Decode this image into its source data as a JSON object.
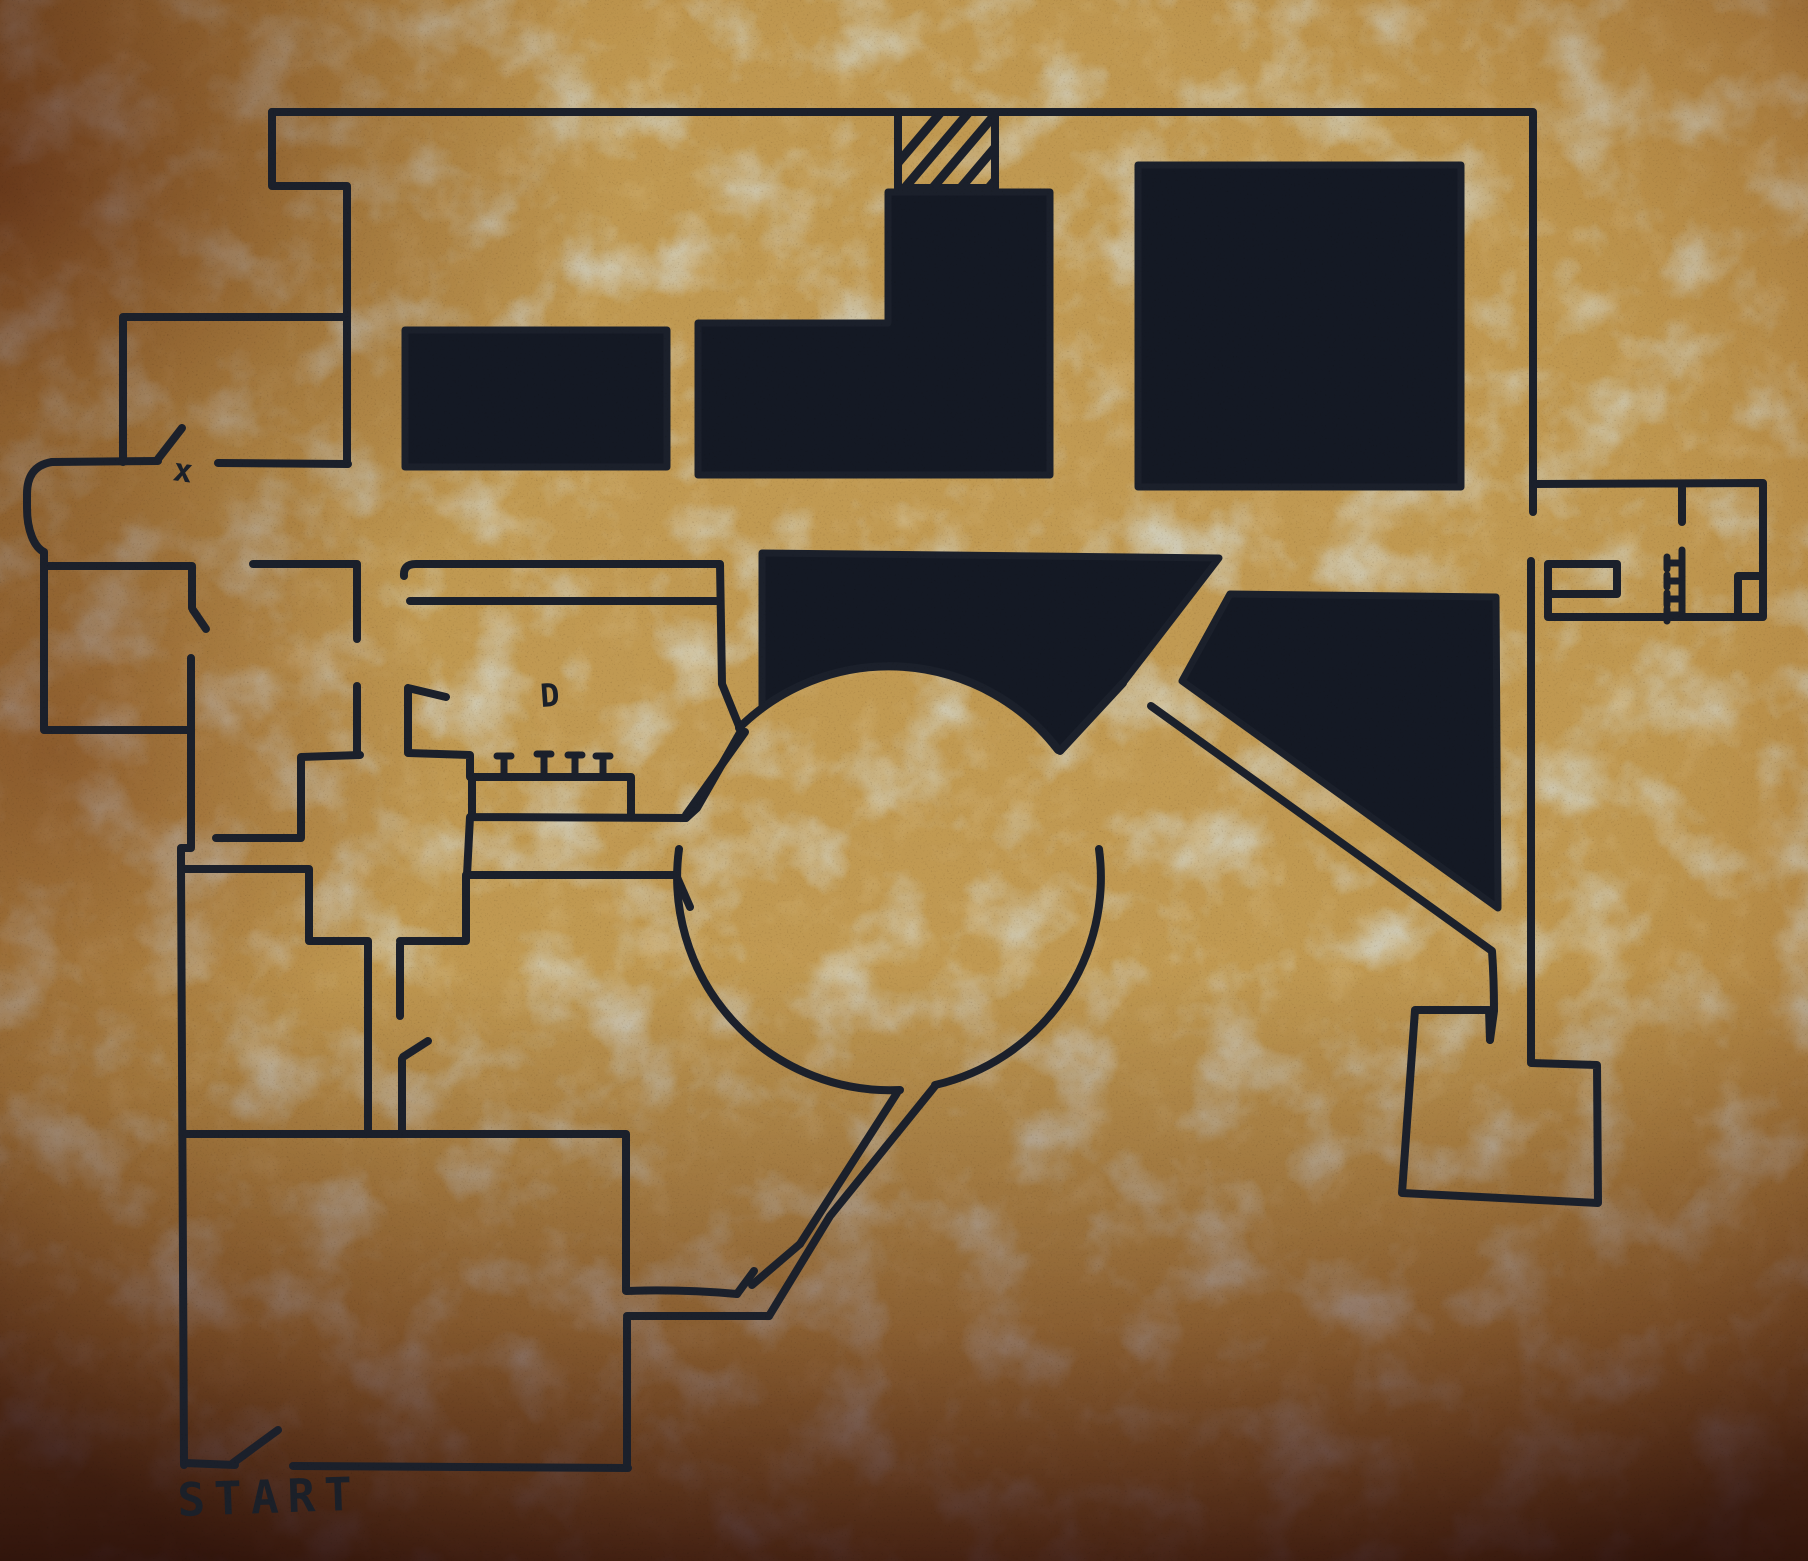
{
  "map": {
    "kind": "hand-drawn level map on parchment",
    "labels": {
      "start": "START",
      "x_mark": "x",
      "d_mark": "D"
    },
    "colors": {
      "ink": "#1b202b",
      "void_room_fill": "#141924",
      "parchment_base": "#c19a52",
      "parchment_light": "#cfae6a",
      "sage_mottle": "#a5a58c",
      "tan_mottle": "#a97f3e",
      "edge_brown": "#8a5a38",
      "corner_maroon": "#7a4440",
      "bottom_maroon": "#5e3338"
    },
    "symbols": {
      "hatched_rectangle_stripes": 6,
      "comb_platform_ticks": 4,
      "ladder_ticks": 4,
      "door_swing_marks": 6,
      "void_rooms": 5,
      "circular_plaza": 1
    }
  }
}
